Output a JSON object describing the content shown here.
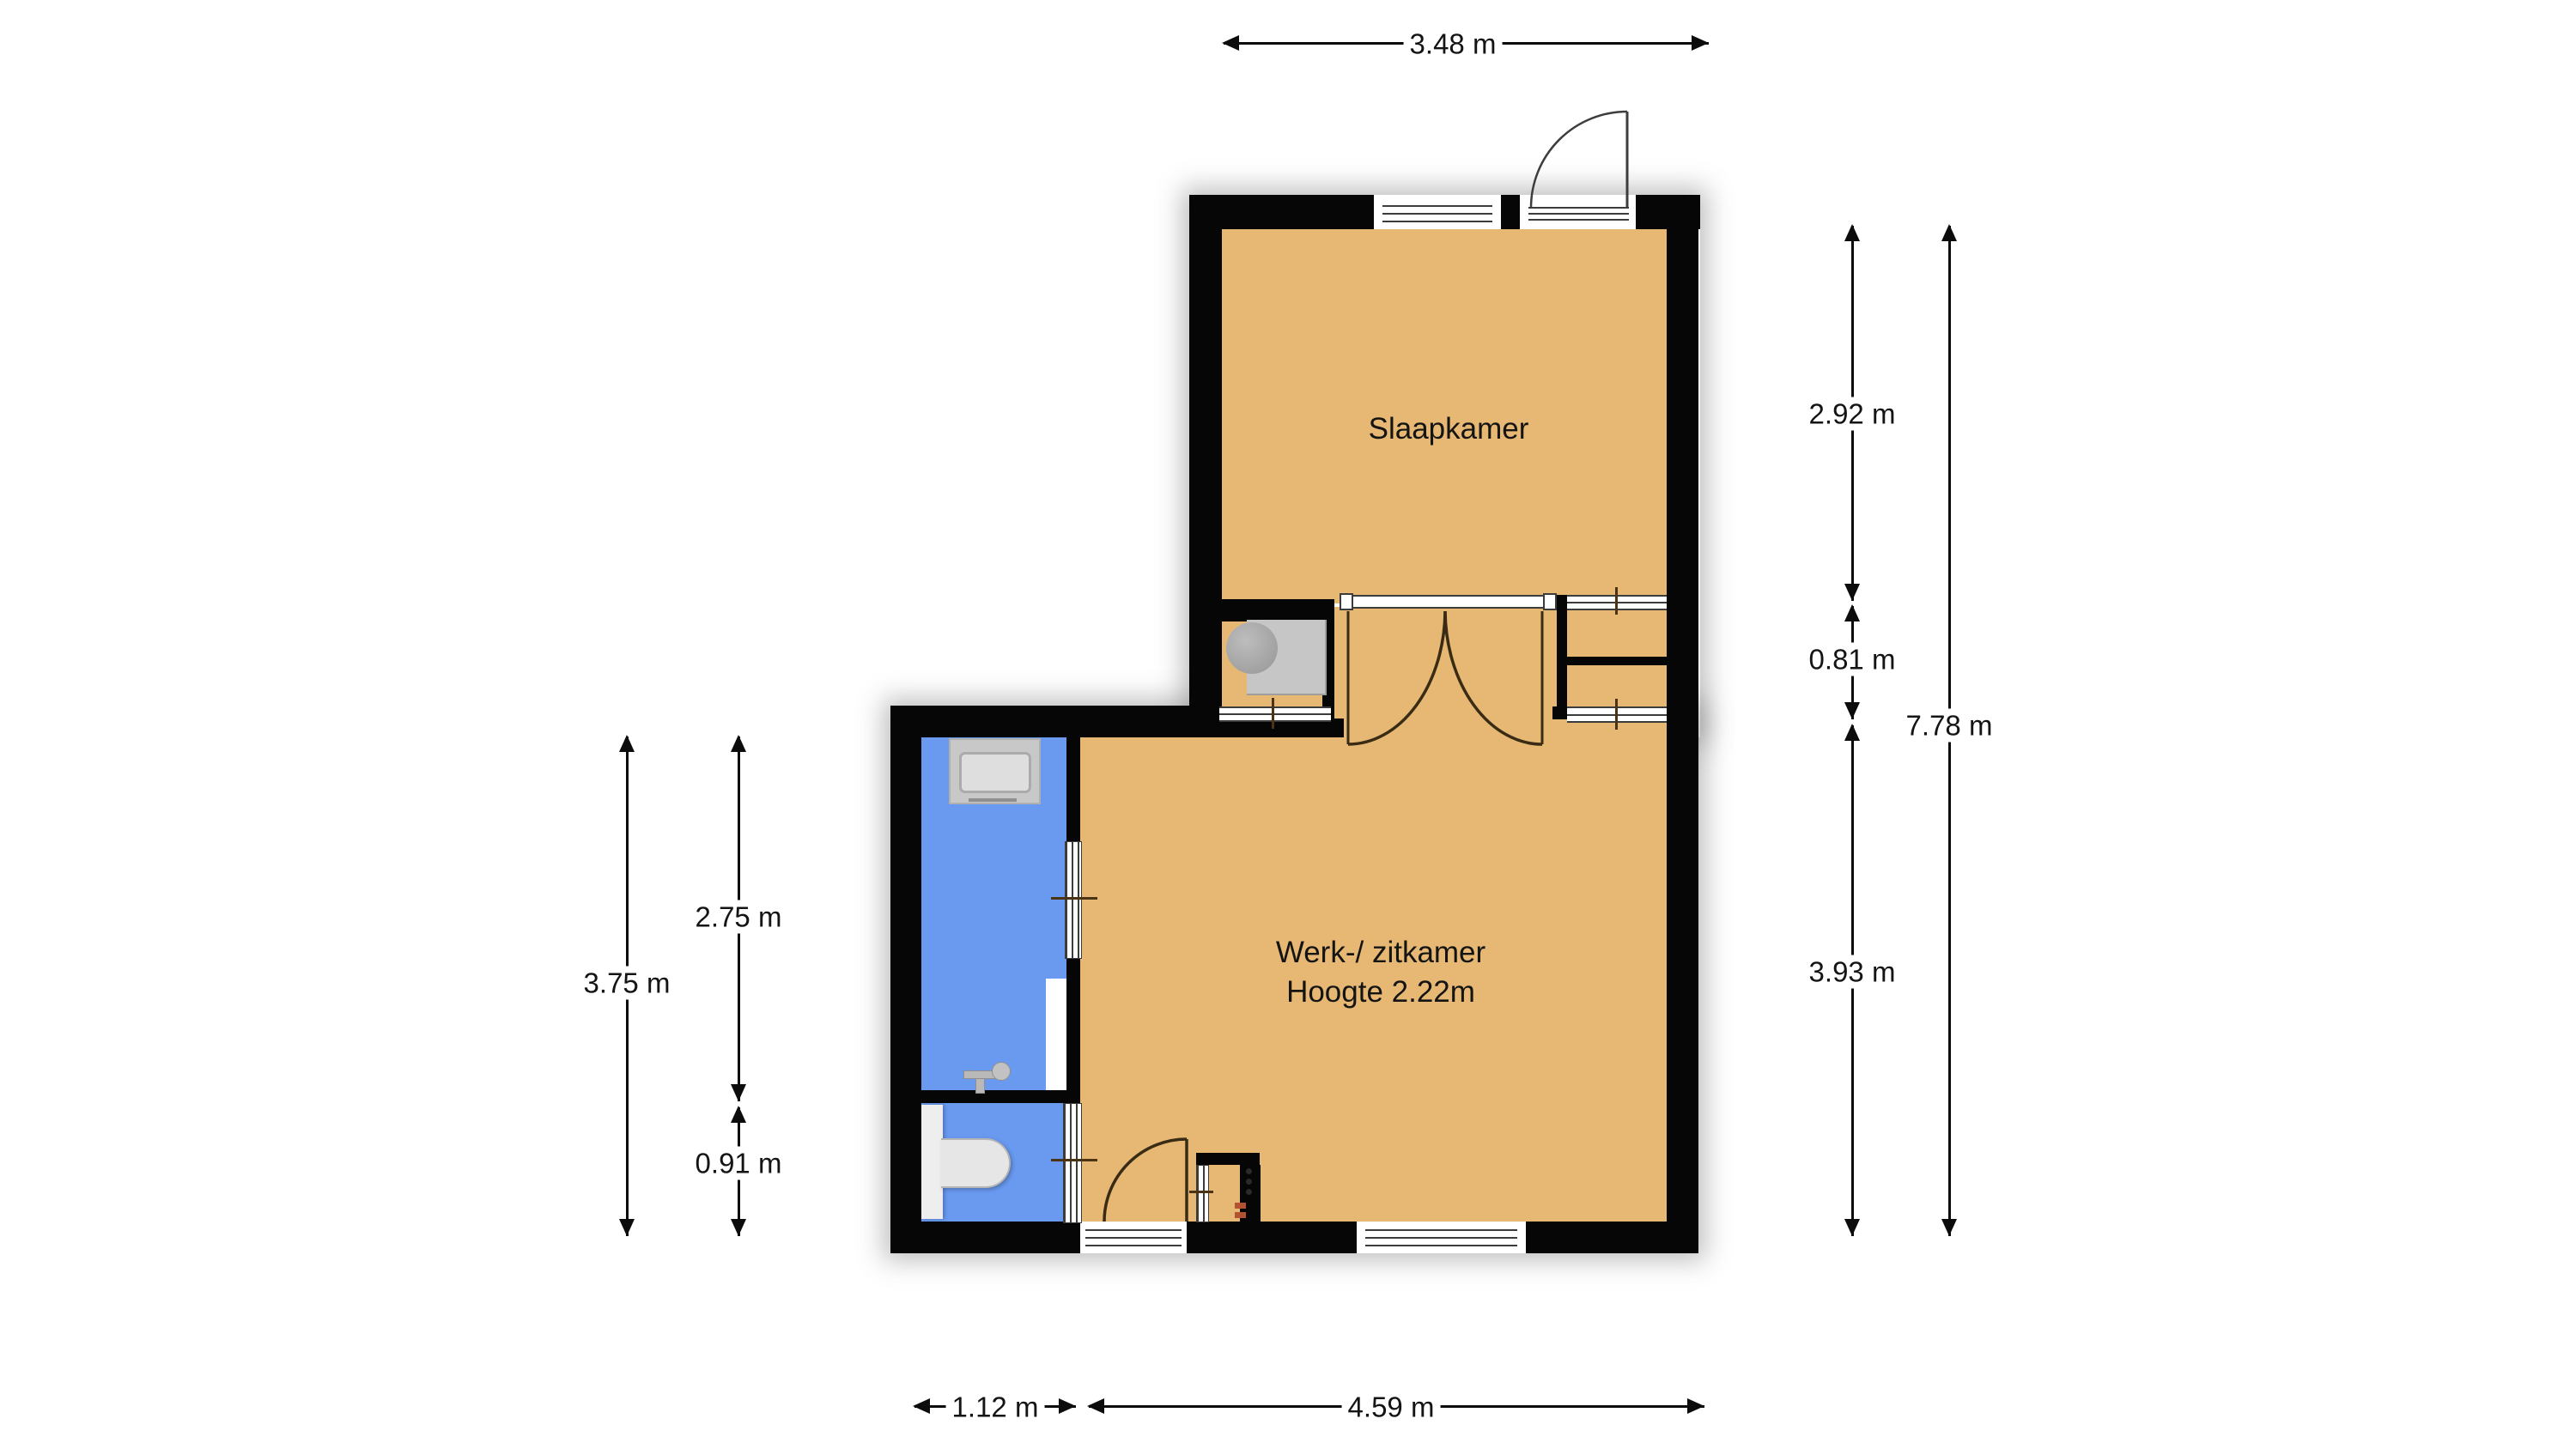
{
  "plan": {
    "type": "floorplan",
    "rooms": [
      {
        "id": "bedroom",
        "label": "Slaapkamer"
      },
      {
        "id": "living",
        "label": "Werk-/ zitkamer",
        "sublabel": "Hoogte 2.22m"
      },
      {
        "id": "bathroom",
        "label": ""
      },
      {
        "id": "toilet",
        "label": ""
      }
    ],
    "dimensions": {
      "top_width": "3.48 m",
      "right_bedroom_height": "2.92 m",
      "right_hall_height": "0.81 m",
      "right_total_height": "7.78 m",
      "right_living_height": "3.93 m",
      "left_wet_total_height": "3.75 m",
      "left_bathroom_height": "2.75 m",
      "left_toilet_height": "0.91 m",
      "bottom_bathroom_width": "1.12 m",
      "bottom_living_width": "4.59 m"
    },
    "colors": {
      "floor": "#e6b873",
      "wet_floor": "#699af0",
      "wall": "#060606"
    }
  }
}
